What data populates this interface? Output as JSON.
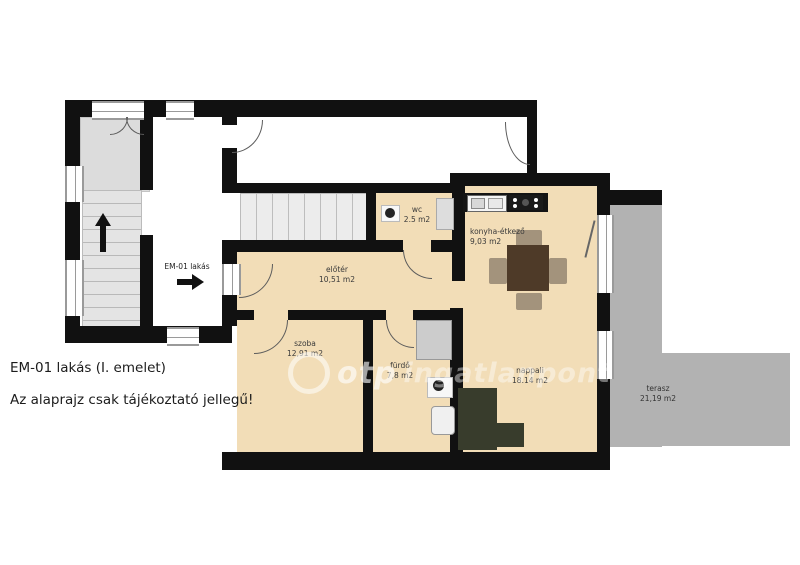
{
  "colors": {
    "wall": "#111111",
    "floor": "#f2ddb7",
    "terrace": "#b2b2b2",
    "vestibule": "#dcdcdc",
    "sofa": "#383c2c",
    "table": "#4e3a28",
    "chair": "#a3937c",
    "tub": "#cccccc"
  },
  "rooms": {
    "wc": {
      "name": "wc",
      "area": "2.5 m2"
    },
    "konyha": {
      "name": "konyha-étkező",
      "area": "9,03 m2"
    },
    "eloter": {
      "name": "előtér",
      "area": "10,51 m2"
    },
    "szoba": {
      "name": "szoba",
      "area": "12,91 m2"
    },
    "furdo": {
      "name": "fürdő",
      "area": "7,8 m2"
    },
    "nappali": {
      "name": "nappali",
      "area": "18.14 m2"
    },
    "terasz": {
      "name": "terasz",
      "area": "21,19 m2"
    }
  },
  "corridor": {
    "label": "EM-01 lakás"
  },
  "footer": {
    "title": "EM-01 lakás (I. emelet)",
    "disclaimer": "Az alaprajz csak tájékoztató jellegű!"
  },
  "watermark": {
    "brand": "otp",
    "suffix": "ingatlanpont"
  }
}
